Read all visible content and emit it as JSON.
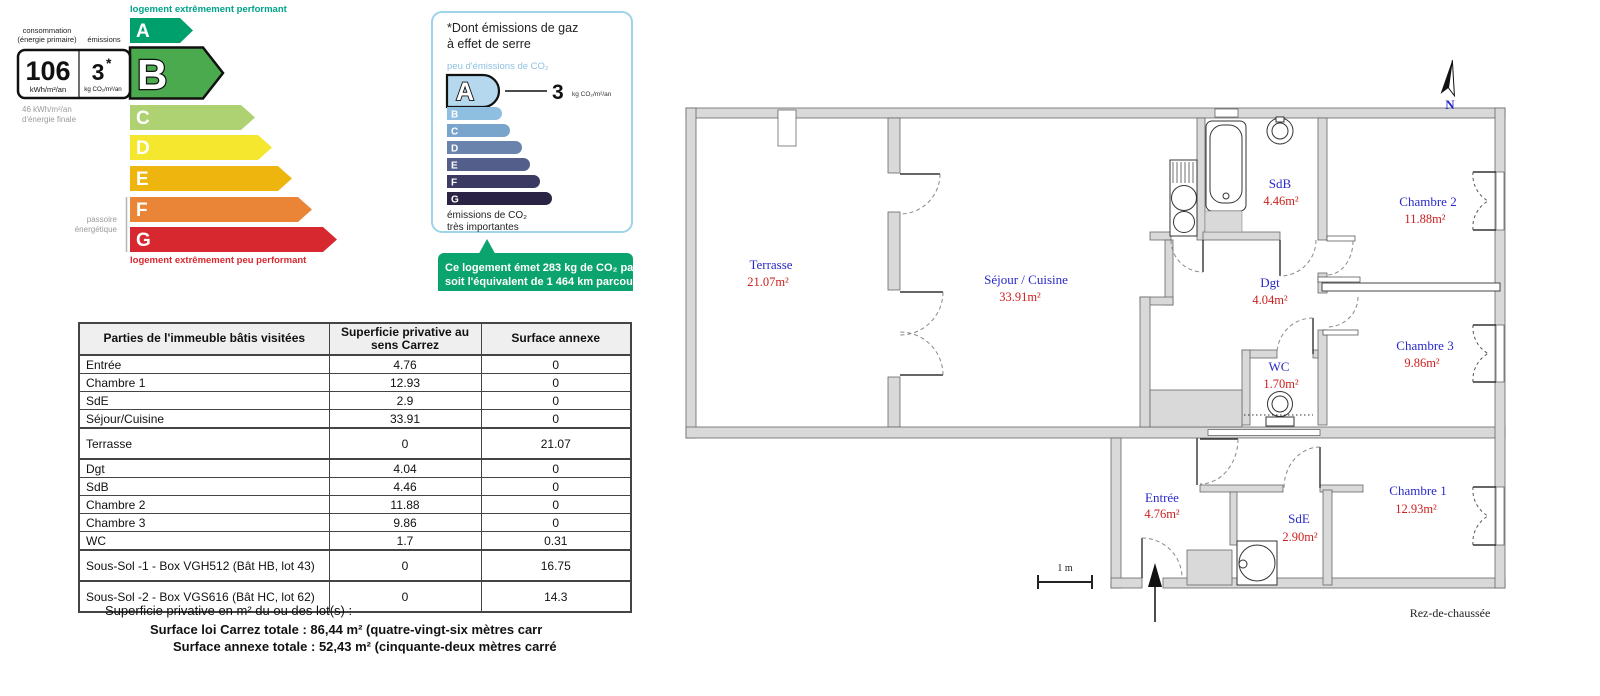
{
  "dpe": {
    "top_label": "logement extrêmement performant",
    "bottom_label": "logement extrêmement peu performant",
    "consumption_header_line1": "consommation",
    "consumption_header_line2": "(énergie primaire)",
    "emissions_header": "émissions",
    "value_energy": "106",
    "value_energy_unit": "kWh/m²/an",
    "value_co2": "3",
    "value_co2_star": "*",
    "value_co2_unit": "kg CO₂/m²/an",
    "final_energy_line1": "46 kWh/m²/an",
    "final_energy_line2": "d'énergie finale",
    "passoire_line1": "passoire",
    "passoire_line2": "énergétique",
    "grades": [
      "A",
      "B",
      "C",
      "D",
      "E",
      "F",
      "G"
    ],
    "current_grade": "B",
    "colors": {
      "A": "#00a06d",
      "B": "#4aaa4d",
      "C": "#aed171",
      "D": "#f4e72e",
      "E": "#efb50f",
      "F": "#ea8437",
      "G": "#d8282f",
      "top_label": "#00a38a"
    }
  },
  "ges": {
    "title_line1": "*Dont émissions de gaz",
    "title_line2": "à effet de serre",
    "low_label": "peu d'émissions de CO₂",
    "value": "3",
    "value_unit": "kg CO₂/m²/an",
    "high_label_line1": "émissions de CO₂",
    "high_label_line2": "très importantes",
    "grades": [
      "A",
      "B",
      "C",
      "D",
      "E",
      "F",
      "G"
    ],
    "current_grade": "A",
    "colors": {
      "A": "#b5d8ef",
      "B": "#8fbfe0",
      "C": "#79a5cd",
      "D": "#6a83ad",
      "E": "#535f8a",
      "F": "#3a3a63",
      "G": "#2a2343",
      "callout": "#0ba36e"
    },
    "callout_line1": "Ce logement émet 283 kg de CO₂ par an,",
    "callout_line2": "soit l'équivalent de 1 464 km parcourus",
    "callout_line3": "en voiture."
  },
  "table": {
    "headers": [
      "Parties de l'immeuble bâtis visitées",
      "Superficie privative au sens Carrez",
      "Surface annexe"
    ],
    "rows": [
      {
        "name": "Entrée",
        "carrez": "4.76",
        "annexe": "0"
      },
      {
        "name": "Chambre 1",
        "carrez": "12.93",
        "annexe": "0"
      },
      {
        "name": "SdE",
        "carrez": "2.9",
        "annexe": "0"
      },
      {
        "name": "Séjour/Cuisine",
        "carrez": "33.91",
        "annexe": "0"
      },
      {
        "name": "Terrasse",
        "carrez": "0",
        "annexe": "21.07"
      },
      {
        "name": "Dgt",
        "carrez": "4.04",
        "annexe": "0"
      },
      {
        "name": "SdB",
        "carrez": "4.46",
        "annexe": "0"
      },
      {
        "name": "Chambre 2",
        "carrez": "11.88",
        "annexe": "0"
      },
      {
        "name": "Chambre 3",
        "carrez": "9.86",
        "annexe": "0"
      },
      {
        "name": "WC",
        "carrez": "1.7",
        "annexe": "0.31"
      },
      {
        "name": "Sous-Sol -1 - Box VGH512 (Bât HB, lot 43)",
        "carrez": "0",
        "annexe": "16.75"
      },
      {
        "name": "Sous-Sol -2 - Box VGS616 (Bât HC, lot 62)",
        "carrez": "0",
        "annexe": "14.3"
      }
    ]
  },
  "summary": {
    "intro": "Superficie privative en m² du ou des lot(s) :",
    "carrez_total": "Surface loi Carrez totale : 86,44 m² (quatre-vingt-six mètres carr",
    "annexe_total": "Surface annexe totale : 52,43 m² (cinquante-deux mètres carré"
  },
  "plan": {
    "north_label": "N",
    "scale_label": "1 m",
    "floor_label": "Rez-de-chaussée",
    "rooms": [
      {
        "name": "Terrasse",
        "area": "21.07m²"
      },
      {
        "name": "Séjour / Cuisine",
        "area": "33.91m²"
      },
      {
        "name": "SdB",
        "area": "4.46m²"
      },
      {
        "name": "Chambre 2",
        "area": "11.88m²"
      },
      {
        "name": "Dgt",
        "area": "4.04m²"
      },
      {
        "name": "Chambre 3",
        "area": "9.86m²"
      },
      {
        "name": "WC",
        "area": "1.70m²"
      },
      {
        "name": "Entrée",
        "area": "4.76m²"
      },
      {
        "name": "SdE",
        "area": "2.90m²"
      },
      {
        "name": "Chambre 1",
        "area": "12.93m²"
      }
    ],
    "label_color": "#2929c8",
    "area_color": "#cc1f1f"
  }
}
